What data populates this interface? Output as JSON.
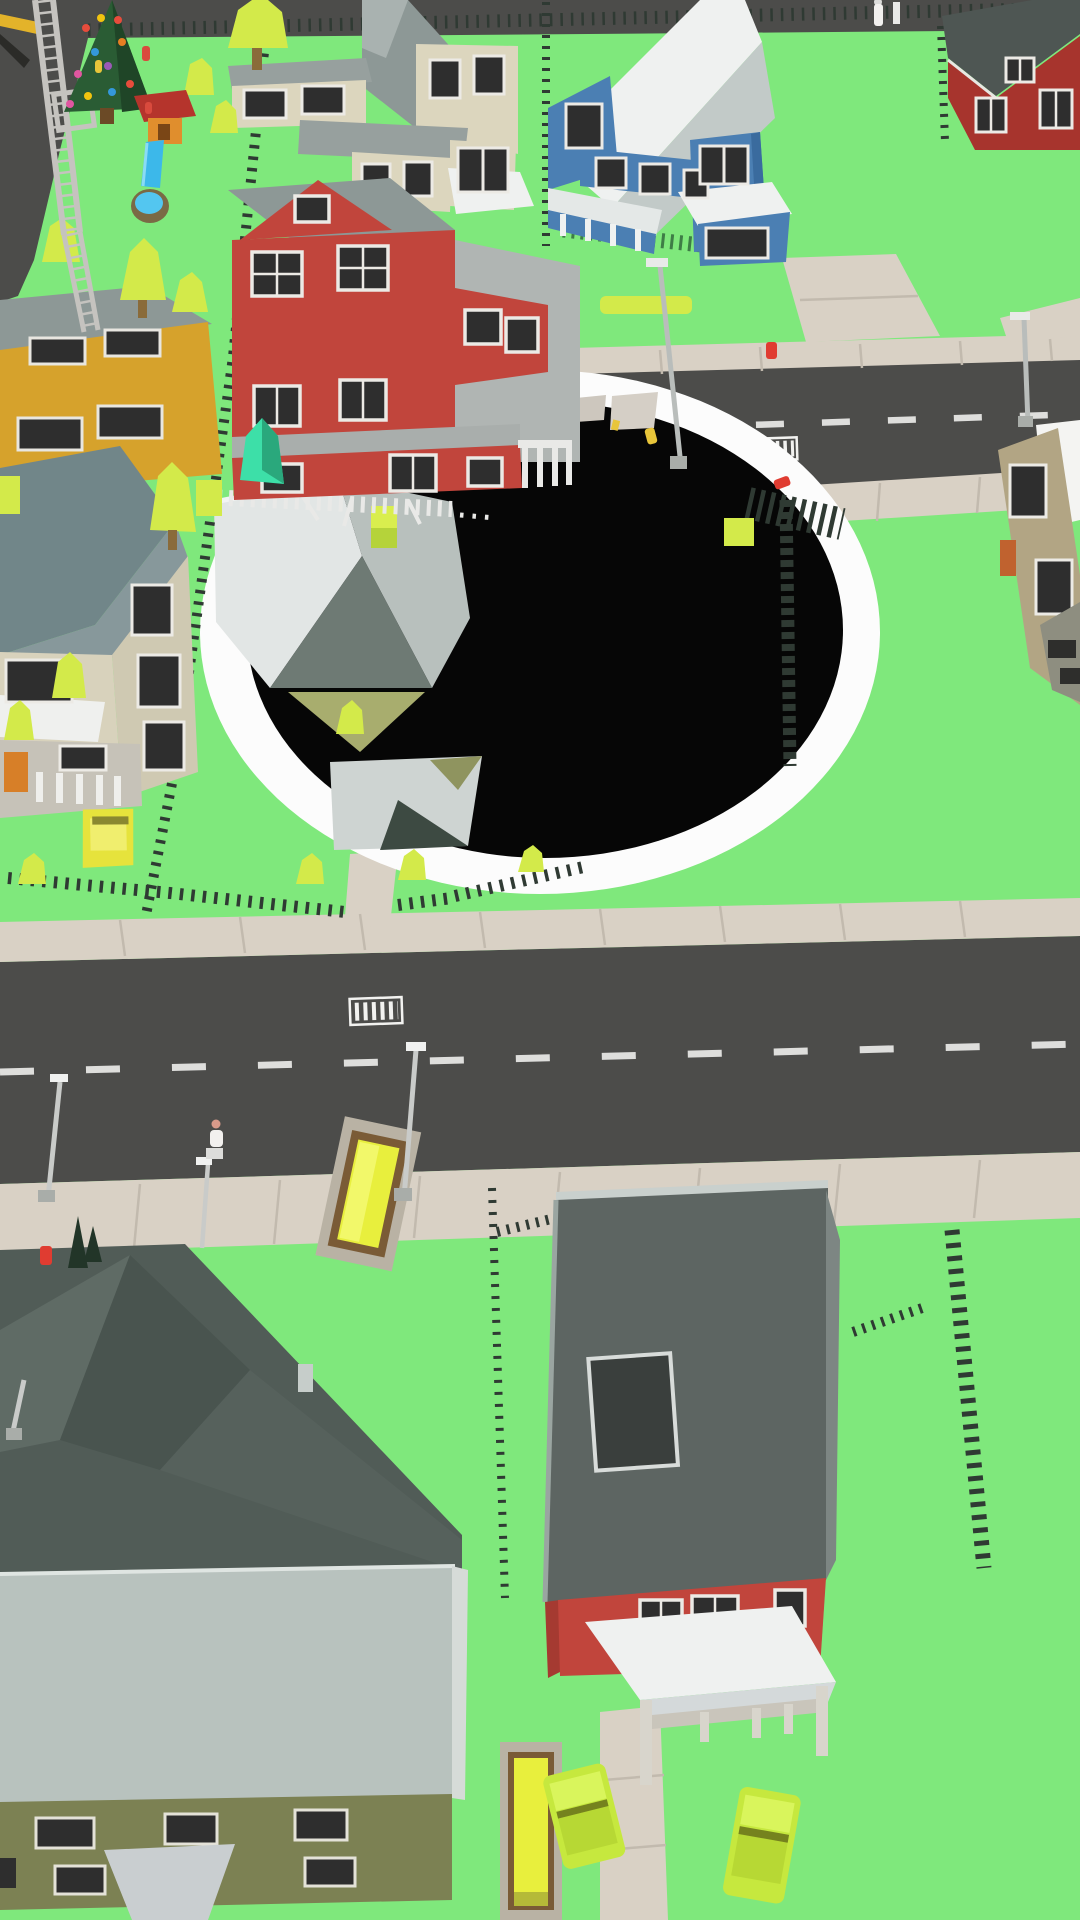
{
  "scene": {
    "type": "arcade-game-screenshot",
    "description": "Top-down low-poly suburban city block; a large black hole with a white rim is swallowing a house, a cube bush and fences between two asphalt roads, bright green lawns, houses, cars, lamps and a small park with a christmas tree, playground, slide and pool",
    "objects": [
      "black-hole",
      "falling-house",
      "red-three-story-house",
      "cream-house",
      "blue-house",
      "red-barn-house",
      "mustard-house",
      "beige-house",
      "khaki-building",
      "olive-large-house",
      "red-roof-house",
      "christmas-tree",
      "power-pylon",
      "crane-beam",
      "playhouse",
      "slide",
      "pool",
      "lime-trees",
      "teal-bush",
      "yellow-car",
      "lime-cars",
      "flatbed-trucks",
      "street-lamps",
      "fire-hydrants",
      "pedestrians",
      "picket-fences",
      "roads",
      "sidewalks",
      "crosswalks"
    ]
  },
  "colors": {
    "grass": "#7FE87C",
    "road": "#4C4C4A",
    "road_line": "#DEDEDC",
    "sidewalk": "#D9D1C5",
    "sidewalk_seam": "#C2BAAE",
    "hole": "#060606",
    "hole_rim": "#FCFCFC",
    "house_red": "#C1453C",
    "house_red_dark": "#A53A31",
    "house_cream": "#DCD6BE",
    "house_blue": "#4B7FB3",
    "barn_red": "#A7342D",
    "house_mustard": "#D6A22C",
    "house_beige": "#CFC9B2",
    "house_khaki": "#B2A584",
    "wall_olive": "#7C8153",
    "roof_white": "#EFF1F0",
    "roof_light": "#E2E6E5",
    "roof_gray": "#8D9896",
    "roof_mid": "#B8C0BD",
    "roof_dark": "#515C57",
    "roof_slate": "#718689",
    "gable_olive": "#A8AD6E",
    "window_dark": "#2E2E2E",
    "window_frame": "#ECEAE5",
    "fence_dark": "#2F3A33",
    "fence_white": "#E9E9E7",
    "fence_green": "#3E7D46",
    "tree_lime": "#D3EA4A",
    "tree_lime_dark": "#A8C438",
    "tree_teal": "#3DDFA8",
    "trunk": "#8A6B3A",
    "car_yellow": "#E6E33C",
    "car_lime": "#C6E83E",
    "truck_frame": "#B9B2A4",
    "truck_bed": "#7A5B36",
    "truck_deck": "#E8EF3D",
    "lamp": "#C9CBC9",
    "hydrant_red": "#E03C31",
    "hydrant_yellow": "#E8C53A",
    "pool_water": "#53C6F0",
    "pool_rim": "#7A6A45",
    "slide_blue": "#3CB8EA",
    "xmas_green": "#2A5C34",
    "play_red": "#B5342C",
    "play_orange": "#E08E2D",
    "person_white": "#F2F0EE",
    "person_red": "#D94A3D",
    "fir_dark": "#223528",
    "crane_yellow": "#E3B32A"
  }
}
